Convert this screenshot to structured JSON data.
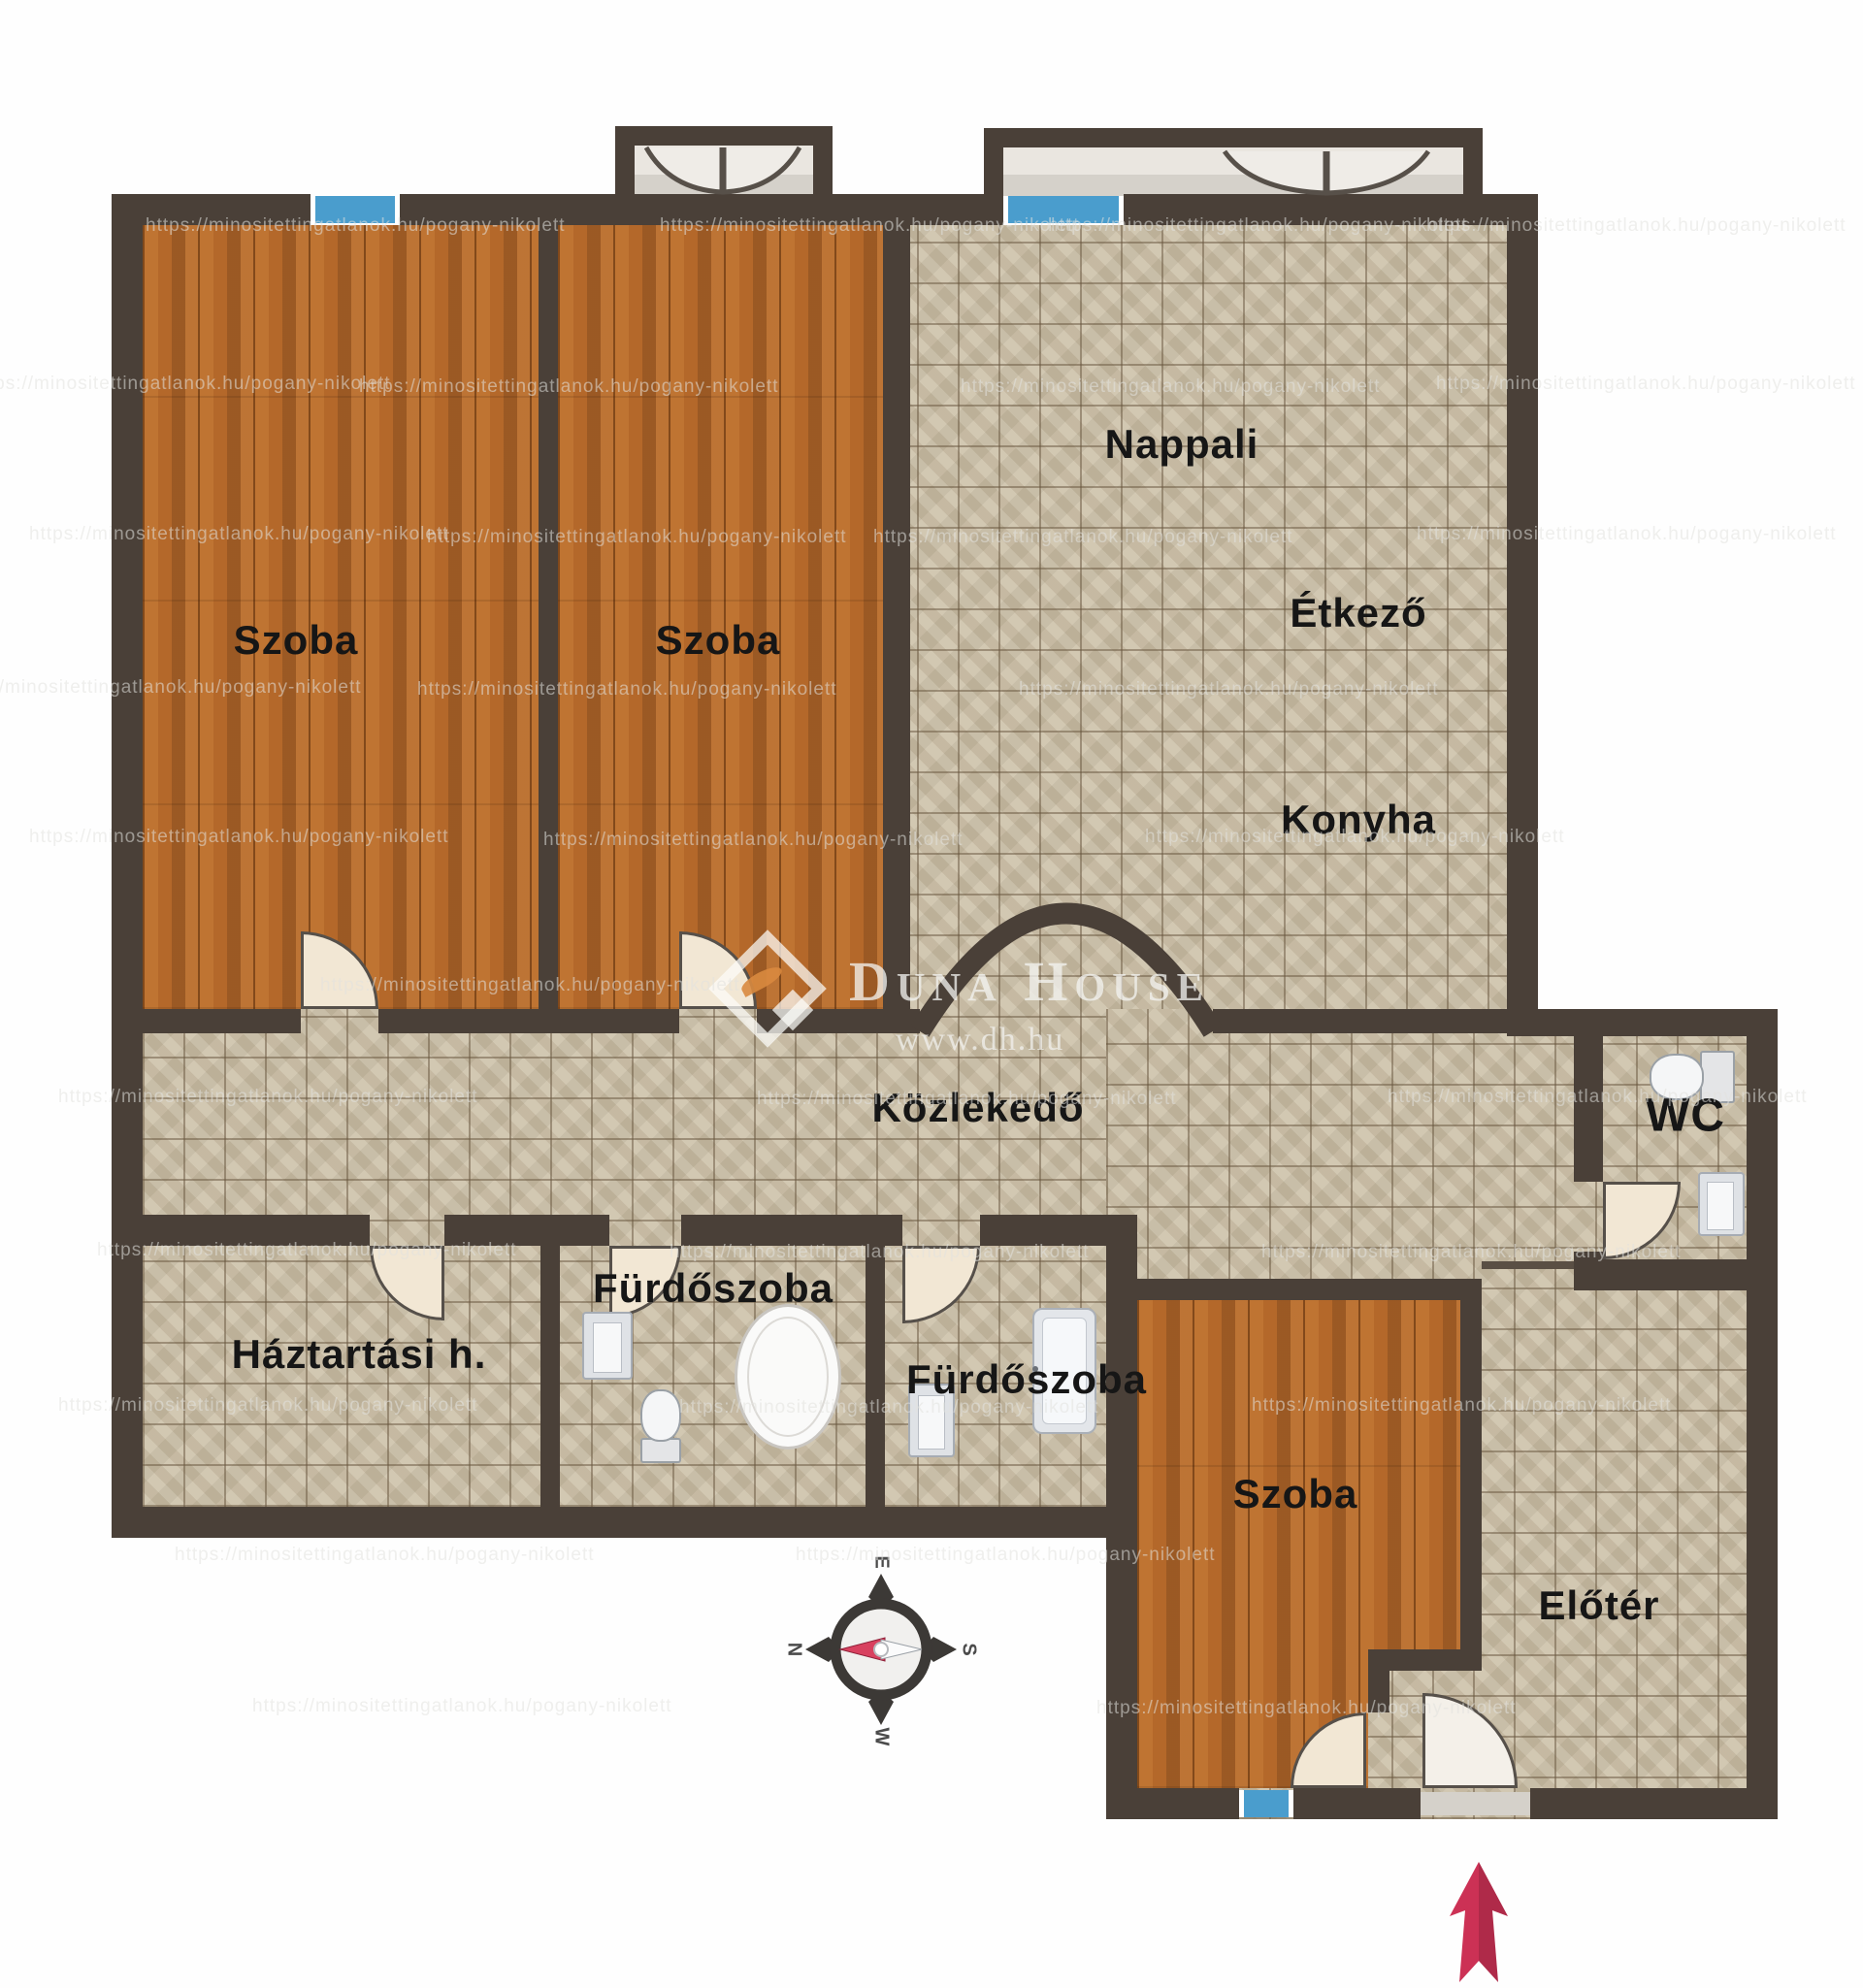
{
  "rooms": {
    "szoba1": "Szoba",
    "szoba2": "Szoba",
    "szoba3": "Szoba",
    "nappali": "Nappali",
    "etkezo": "Étkező",
    "konyha": "Konyha",
    "kozlekedo": "Közlekedő",
    "wc": "WC",
    "furdoszoba1": "Fürdőszoba",
    "furdoszoba2": "Fürdőszoba",
    "haztartasi": "Háztartási h.",
    "eloter": "Előtér"
  },
  "watermark": {
    "url_text": "https://minositettingatlanok.hu/pogany-nikolett"
  },
  "brand": {
    "name": "Duna House",
    "website": "www.dh.hu"
  },
  "compass": {
    "top": "E",
    "left": "N",
    "right": "S",
    "bottom": "W"
  },
  "colors": {
    "wall": "#4a4038",
    "tile_floor": "#cbbfa6",
    "wood_floor": "#b4682a",
    "window_blue": "#4a9dcd",
    "door_fill": "#f2e7d4",
    "entrance_arrow": "#cc3155"
  }
}
